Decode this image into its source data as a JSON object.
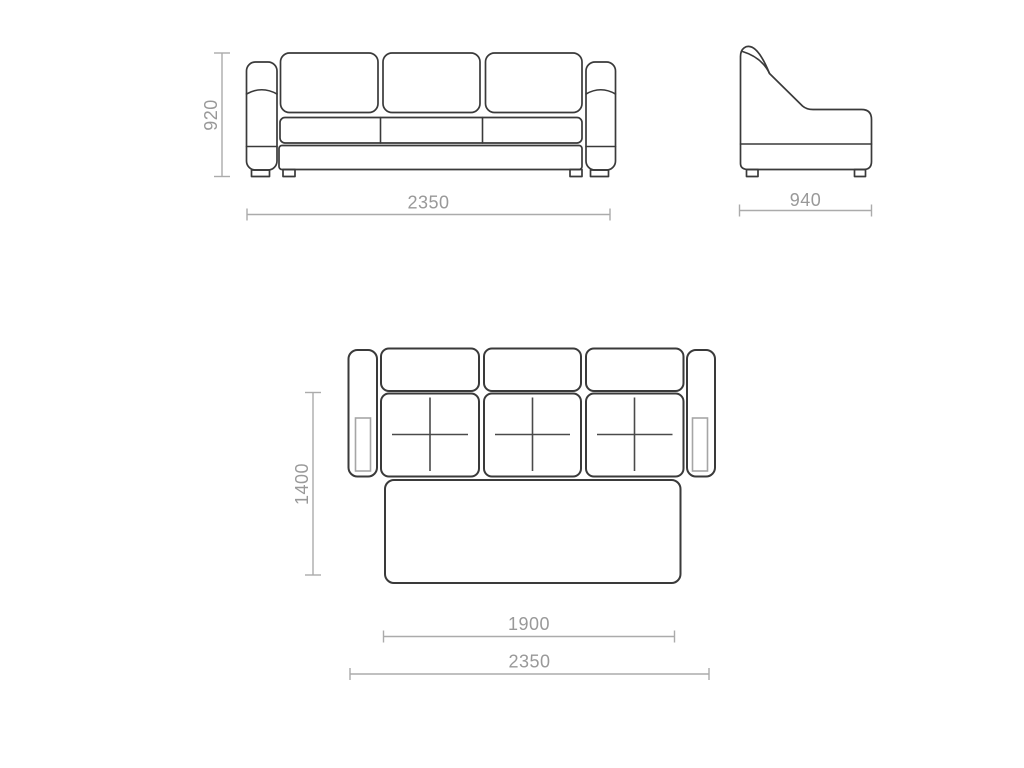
{
  "drawing": {
    "type": "sofa-bed technical drawing, three orthographic views",
    "colors": {
      "background": "#ffffff",
      "outline": "#3a3a3a",
      "cross": "#4a4a4a",
      "armrest_detail": "#a6a6a6",
      "dimension_line": "#ababab",
      "dimension_text": "#999999"
    }
  },
  "dimensions": {
    "front": {
      "height": "920",
      "width": "2350"
    },
    "side": {
      "depth": "940"
    },
    "plan": {
      "depth": "1400",
      "bed_width": "1900",
      "total_width": "2350"
    }
  }
}
